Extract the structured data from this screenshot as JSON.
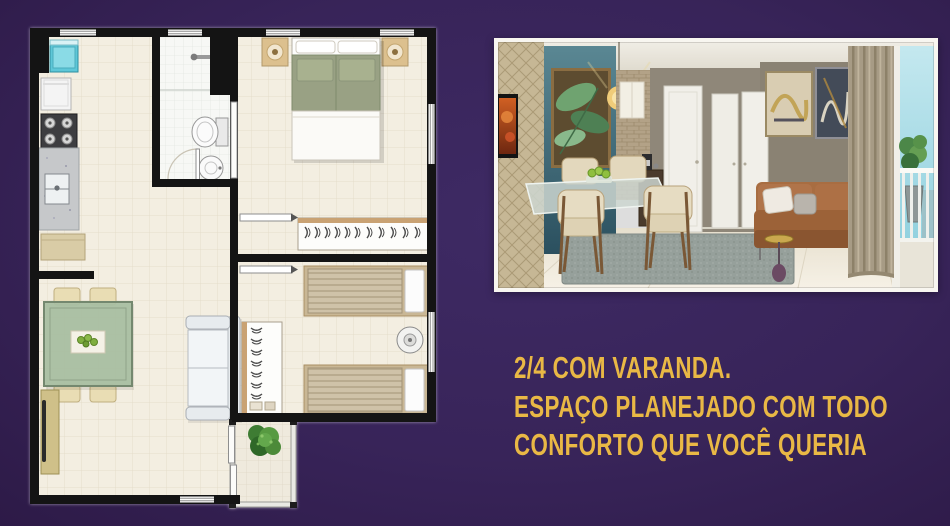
{
  "canvas": {
    "width": 950,
    "height": 526,
    "background_color": "#382459"
  },
  "headline": {
    "color": "#e9b845",
    "lines": [
      "2/4 COM VARANDA.",
      "ESPAÇO PLANEJADO COM TODO",
      "CONFORTO QUE VOCÊ QUERIA"
    ]
  },
  "floor_plan": {
    "kind": "top-down apartment floor plan, no text labels",
    "wall_color": "#141414",
    "floor_color": "#f3eee1",
    "rooms": [
      {
        "name": "kitchen",
        "items": [
          "laundry-tank",
          "refrigerator",
          "stove",
          "counter-with-sink",
          "cabinet"
        ]
      },
      {
        "name": "bathroom",
        "items": [
          "shower",
          "toilet",
          "washbasin"
        ]
      },
      {
        "name": "couple-bedroom",
        "items": [
          "double-bed",
          "nightstand-lamp",
          "nightstand-lamp",
          "wardrobe-with-hangers"
        ]
      },
      {
        "name": "living-dining",
        "items": [
          "dining-table",
          "four-chairs",
          "tv-rack",
          "sofa"
        ]
      },
      {
        "name": "second-bedroom",
        "items": [
          "single-bed",
          "single-bed",
          "wardrobe-with-hangers",
          "fan"
        ]
      },
      {
        "name": "balcony",
        "items": [
          "plant",
          "sliding-door"
        ]
      }
    ]
  },
  "photo": {
    "kind": "interior render of dining / living room with balcony",
    "elements": [
      "leaf-artwork",
      "teal-accent-wall",
      "pendant-lamp",
      "tv",
      "stone-mosaic-wall",
      "white-doors",
      "coffee-station",
      "dining-table-with-chairs",
      "gray-rug",
      "leather-sofa",
      "wall-art-frames",
      "curtain",
      "balcony-railing",
      "potted-plant",
      "sky"
    ]
  }
}
